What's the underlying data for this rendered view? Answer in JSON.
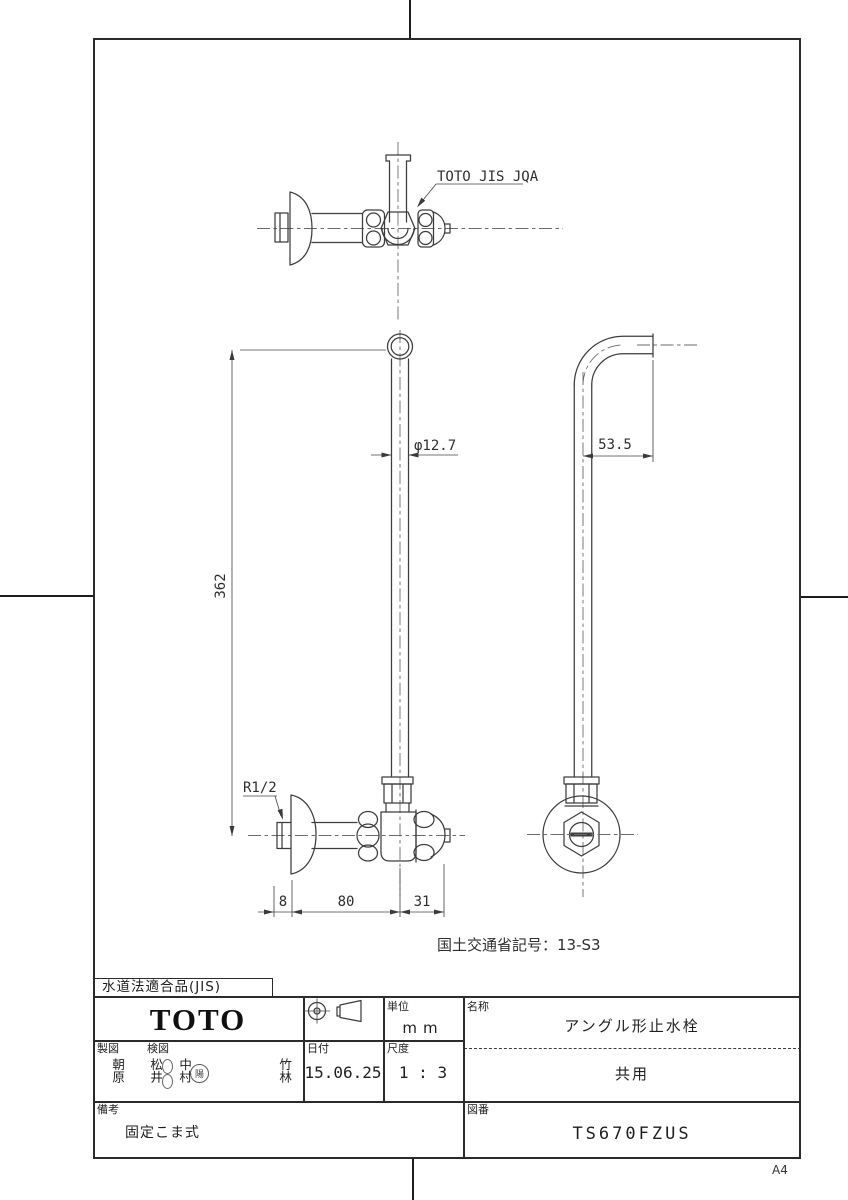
{
  "page": {
    "paper_size_label": "A4"
  },
  "drawing": {
    "certification_label": "TOTO JIS JQA",
    "ministry_code": "国土交通省記号：13-S3",
    "dimensions": {
      "pipe_diameter": "φ12.7",
      "pipe_length": "362",
      "bend_offset": "53.5",
      "thread": "R1/2",
      "wall_offset": "8",
      "body_length": "80",
      "handle_length": "31"
    }
  },
  "title_block": {
    "compliance": "水道法適合品(JIS)",
    "manufacturer": "TOTO",
    "unit": {
      "label": "単位",
      "value": "mm"
    },
    "name": {
      "label": "名称",
      "value": "アングル形止水栓"
    },
    "shared_use": "共用",
    "drafter": {
      "label": "製図",
      "name": "朝原"
    },
    "checker": {
      "label": "検図",
      "names": [
        "松井",
        "中村",
        "竹林"
      ],
      "stamp": "陽"
    },
    "date": {
      "label": "日付",
      "value": "15.06.25"
    },
    "scale": {
      "label": "尺度",
      "value": "1 : 3"
    },
    "remarks": {
      "label": "備考",
      "value": "固定こま式"
    },
    "drawing_number": {
      "label": "図番",
      "value": "TS670FZUS"
    }
  }
}
